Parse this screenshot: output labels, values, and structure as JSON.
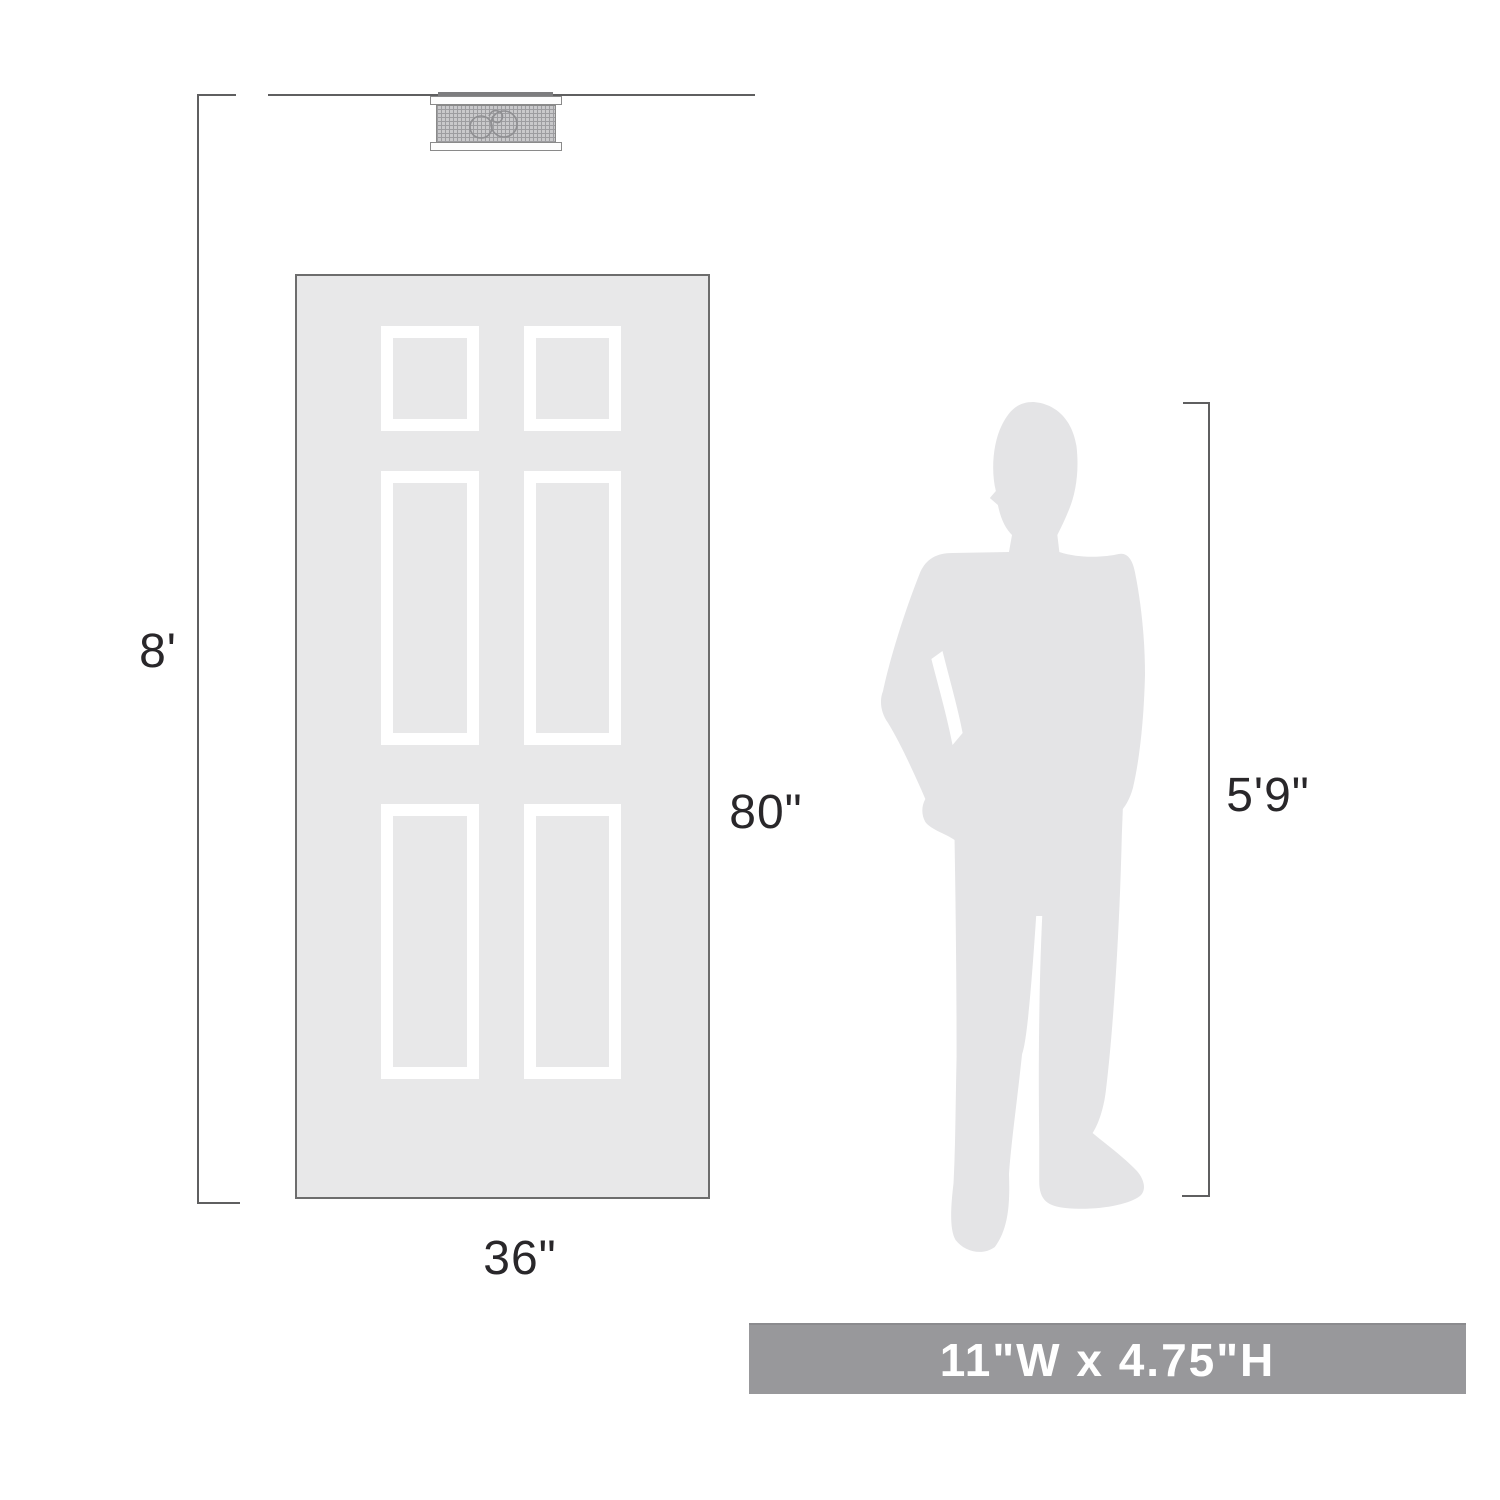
{
  "diagram": {
    "ceiling_height_label": "8'",
    "door": {
      "height_label": "80\"",
      "width_label": "36\""
    },
    "person": {
      "height_label": "5'9\""
    },
    "banner": {
      "text": "11\"W x 4.75\"H"
    }
  },
  "figures": {
    "fixture": "flush-mount-ceiling-light",
    "door": "six-panel-door",
    "person": "standing-man-silhouette"
  },
  "colors": {
    "silhouette": "#e4e4e6",
    "door_fill": "#e8e8e9",
    "door_border": "#6d6d6d",
    "panel_frame": "#ffffff",
    "line": "#5f5f60",
    "text": "#29272a",
    "banner_bg": "#98989b",
    "banner_text": "#ffffff",
    "fixture_mesh": "#c9c9cb"
  }
}
